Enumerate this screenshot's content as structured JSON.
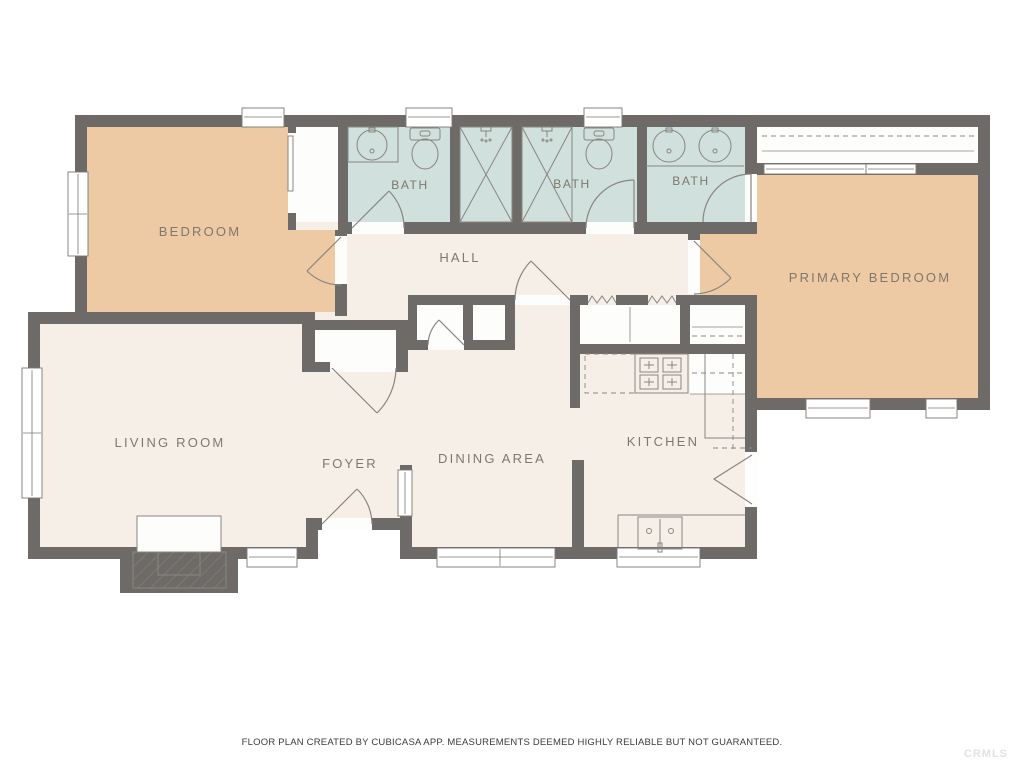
{
  "plan": {
    "rooms": [
      {
        "name": "bedroom",
        "label": "BEDROOM"
      },
      {
        "name": "bath-1",
        "label": "BATH"
      },
      {
        "name": "bath-2",
        "label": "BATH"
      },
      {
        "name": "bath-3",
        "label": "BATH"
      },
      {
        "name": "hall",
        "label": "HALL"
      },
      {
        "name": "primary-bedroom",
        "label": "PRIMARY BEDROOM"
      },
      {
        "name": "living-room",
        "label": "LIVING ROOM"
      },
      {
        "name": "foyer",
        "label": "FOYER"
      },
      {
        "name": "dining-area",
        "label": "DINING AREA"
      },
      {
        "name": "kitchen",
        "label": "KITCHEN"
      }
    ],
    "footer": "FLOOR PLAN CREATED BY CUBICASA APP. MEASUREMENTS DEEMED HIGHLY RELIABLE BUT NOT GUARANTEED.",
    "watermark": "CRMLS",
    "colors": {
      "wall": "#6e6a67",
      "room": "#f5efe8",
      "bedroom": "#edcaa3",
      "bath": "#cfe0dd",
      "closet": "#fdfdfc",
      "line": "#8a857f",
      "label": "#7f786e",
      "background": "#ffffff"
    }
  }
}
